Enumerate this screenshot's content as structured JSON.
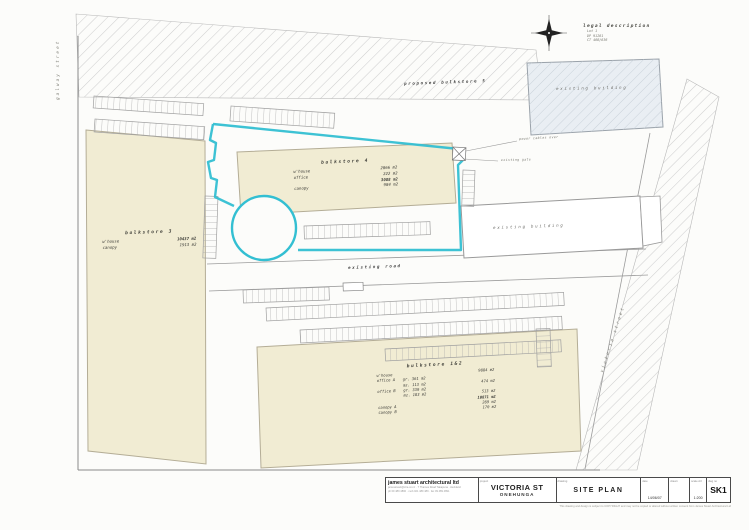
{
  "colors": {
    "teal": "#33bfd2",
    "cream": "#f1ecd3",
    "hatch_line": "#cfcfcf",
    "existing_fill": "#e9eef3"
  },
  "streets": {
    "left": "galway street",
    "right": "victoria street"
  },
  "legal": {
    "title": "legal description",
    "line1": "Lot 1",
    "line2": "DP 91281",
    "line3": "CT 46B/836"
  },
  "labels": {
    "proposed": "proposed bulkstore 5",
    "existing_building_top": "existing building",
    "existing_building_mid": "existing building",
    "existing_road": "existing road",
    "power_cables": "power cables over",
    "existing_gate": "existing gate"
  },
  "bulkstore3": {
    "title": "bulkstore 3",
    "r1l": "w'house",
    "r1v": "10437 m2",
    "r2l": "canopy",
    "r2v": "1913 m2"
  },
  "bulkstore4": {
    "title": "bulkstore 4",
    "r1l": "w'house",
    "r1v": "2866 m2",
    "r2l": "office",
    "r2v": "222 m2",
    "totv": "3088 m2",
    "r3l": "canopy",
    "r3v": "984 m2"
  },
  "bulkstore12": {
    "title": "bulkstore 1&2",
    "rows": [
      {
        "l": "w'house",
        "m": "",
        "v": "9884 m2"
      },
      {
        "l": "office A",
        "m": "gr. 361 m2",
        "v": ""
      },
      {
        "l": "",
        "m": "mz. 113 m2",
        "v": "474 m2"
      },
      {
        "l": "office B",
        "m": "gr. 330 m2",
        "v": ""
      },
      {
        "l": "",
        "m": "mz. 183 m2",
        "v": "513 m2"
      },
      {
        "l": "",
        "m": "",
        "v": "10871 m2"
      },
      {
        "l": "canopy A",
        "m": "",
        "v": "289 m2"
      },
      {
        "l": "canopy B",
        "m": "",
        "v": "170 m2"
      }
    ]
  },
  "titleblock": {
    "firm": "james stuart architectural ltd",
    "firm_line1": "jamesstuart@xtra.co.nz · 7 Thames Road Takapuna · Auckland",
    "firm_line2": "ph 09 489 4890 · mob 021 489 489 · fax 09 489 4891",
    "project_label": "project",
    "project": "VICTORIA ST",
    "suburb": "ONEHUNGA",
    "drawing_label": "drawing",
    "drawing": "SITE PLAN",
    "date_label": "date",
    "date": "14/06/07",
    "drawn_label": "drawn",
    "drawn": "",
    "scale_label": "scale A3",
    "scale": "1:200",
    "number_label": "dwg no",
    "number": "SK1",
    "copyright": "This drawing and design is subject to COPYRIGHT and may not be copied or altered without written consent from James Stuart Architectural Ltd"
  }
}
